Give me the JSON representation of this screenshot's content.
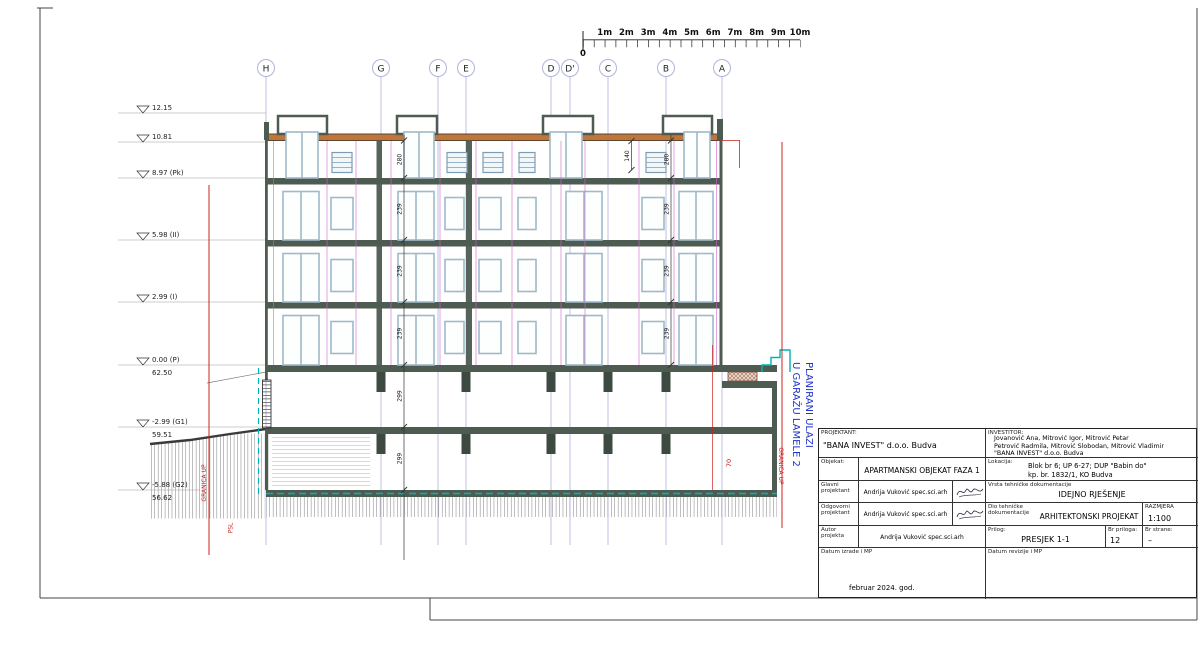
{
  "colors": {
    "slab": "#4e5b51",
    "roof_band": "#c0763a",
    "window_frame": "#9fb9c9",
    "grid_line": "#9aa2d8",
    "boundary_red": "#cc2222",
    "utility_cyan": "#00b4b4",
    "annotation_blue": "#2233cc",
    "section_magenta": "#cc66cc"
  },
  "scale_bar": {
    "zero": "0",
    "labels": [
      "1m",
      "2m",
      "3m",
      "4m",
      "5m",
      "6m",
      "7m",
      "8m",
      "9m",
      "10m"
    ]
  },
  "grid": {
    "labels": [
      "H",
      "G",
      "F",
      "E",
      "D",
      "D'",
      "C",
      "B",
      "A"
    ]
  },
  "elevations": [
    {
      "value": "12.15",
      "datum": ""
    },
    {
      "value": "10.81",
      "datum": ""
    },
    {
      "value": "8.97 (Pk)",
      "datum": ""
    },
    {
      "value": "5.98 (II)",
      "datum": ""
    },
    {
      "value": "2.99 (I)",
      "datum": ""
    },
    {
      "value": "0.00 (P)",
      "datum": "62.50"
    },
    {
      "value": "-2.99 (G1)",
      "datum": "59.51"
    },
    {
      "value": "-5.88 (G2)",
      "datum": "56.62"
    }
  ],
  "dims": {
    "left": [
      "280",
      "239",
      "239",
      "239",
      "299",
      "299"
    ],
    "right": [
      "280",
      "239",
      "239",
      "239"
    ],
    "attic": "140",
    "red": "70"
  },
  "annotations": {
    "granica_up_left": "GRANICA UP",
    "psl": "PSL",
    "granica_up_right": "GRANICA UP",
    "entrance_line1": "PLANIRANI ULAZI",
    "entrance_line2": "U GARAŽU LAMELE 2"
  },
  "title_block": {
    "projektant_label": "PROJEKTANT:",
    "projektant": "\"BANA INVEST\" d.o.o. Budva",
    "investitor_label": "INVESTITOR:",
    "investitor_line1": "Jovanović Ana, Mitrović Igor, Mitrović Petar",
    "investitor_line2": "Petrović Radmila, Mitrović Slobodan, Mitrović Vladimir",
    "investitor_line3": "\"BANA INVEST\" d.o.o. Budva",
    "objekat_label": "Objekat:",
    "objekat": "APARTMANSKI OBJEKAT FAZA 1",
    "lokacija_label": "Lokacija:",
    "lokacija_line1": "Blok br 6; UP 6-27;  DUP \"Babin do\"",
    "lokacija_line2": "kp. br. 1832/1,  KO Budva",
    "glavni_label": "Glavni projektant",
    "odgovorni_label": "Odgovorni projektant",
    "autor_label": "Autor projekta",
    "designer_name": "Andrija Vuković spec.sci.arh",
    "vrsta_label": "Vrsta tehničke dokumentacije",
    "vrsta": "IDEJNO RJEŠENJE",
    "dio_label": "Dio tehničke dokumentacije",
    "dio": "ARHITEKTONSKI PROJEKAT",
    "razmjera_label": "RAZMJERA",
    "razmjera": "1:100",
    "prilog_label": "Prilog:",
    "prilog": "PRESJEK  1-1",
    "br_priloga_label": "Br priloga:",
    "br_priloga": "12",
    "br_strane_label": "Br strane:",
    "br_strane": "–",
    "datum_izrade_label": "Datum izrade i MP",
    "datum_izrade": "februar 2024. god.",
    "datum_revizije_label": "Datum revizije i MP"
  }
}
